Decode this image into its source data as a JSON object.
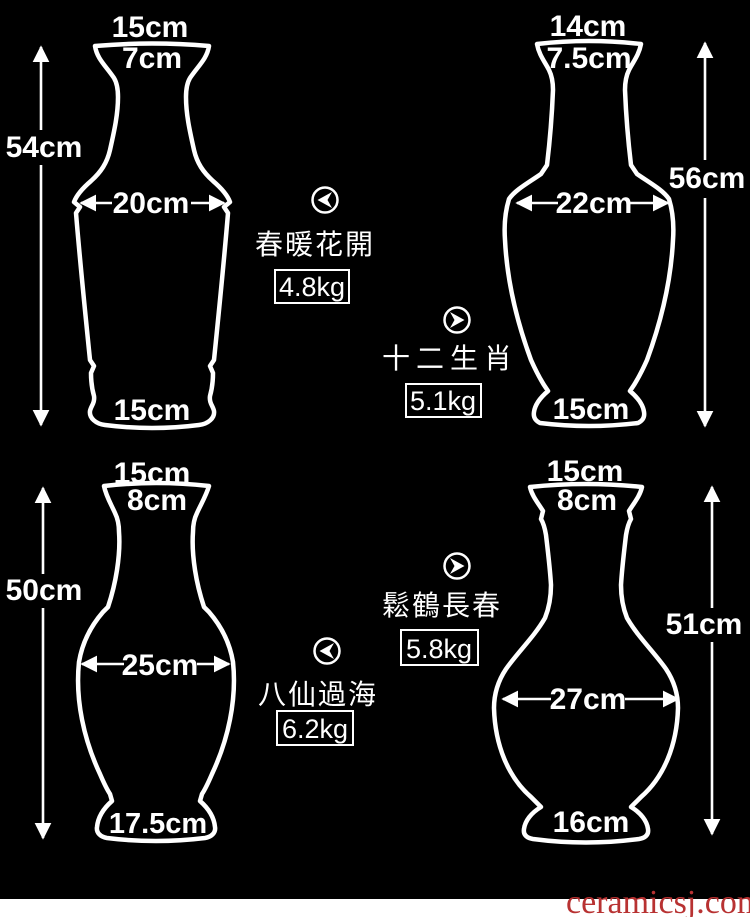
{
  "page": {
    "background_color": "#000000",
    "outline_color": "#ffffff",
    "watermark": {
      "text": "ceramicsj.com",
      "color": "#b83232",
      "strip_color": "#ffffff"
    }
  },
  "vases": [
    {
      "name": "春暖花開",
      "weight": "4.8kg",
      "mouth_width": "15cm",
      "mouth_inner_width": "7cm",
      "height": "54cm",
      "body_width": "20cm",
      "base_width": "15cm",
      "nav_icon": "chevron-left"
    },
    {
      "name": "十二生肖",
      "weight": "5.1kg",
      "mouth_width": "14cm",
      "mouth_inner_width": "7.5cm",
      "height": "56cm",
      "body_width": "22cm",
      "base_width": "15cm",
      "nav_icon": "chevron-right"
    },
    {
      "name": "八仙過海",
      "weight": "6.2kg",
      "mouth_width": "15cm",
      "mouth_inner_width": "8cm",
      "height": "50cm",
      "body_width": "25cm",
      "base_width": "17.5cm",
      "nav_icon": "chevron-left"
    },
    {
      "name": "鬆鶴長春",
      "weight": "5.8kg",
      "mouth_width": "15cm",
      "mouth_inner_width": "8cm",
      "height": "51cm",
      "body_width": "27cm",
      "base_width": "16cm",
      "nav_icon": "chevron-right"
    }
  ]
}
